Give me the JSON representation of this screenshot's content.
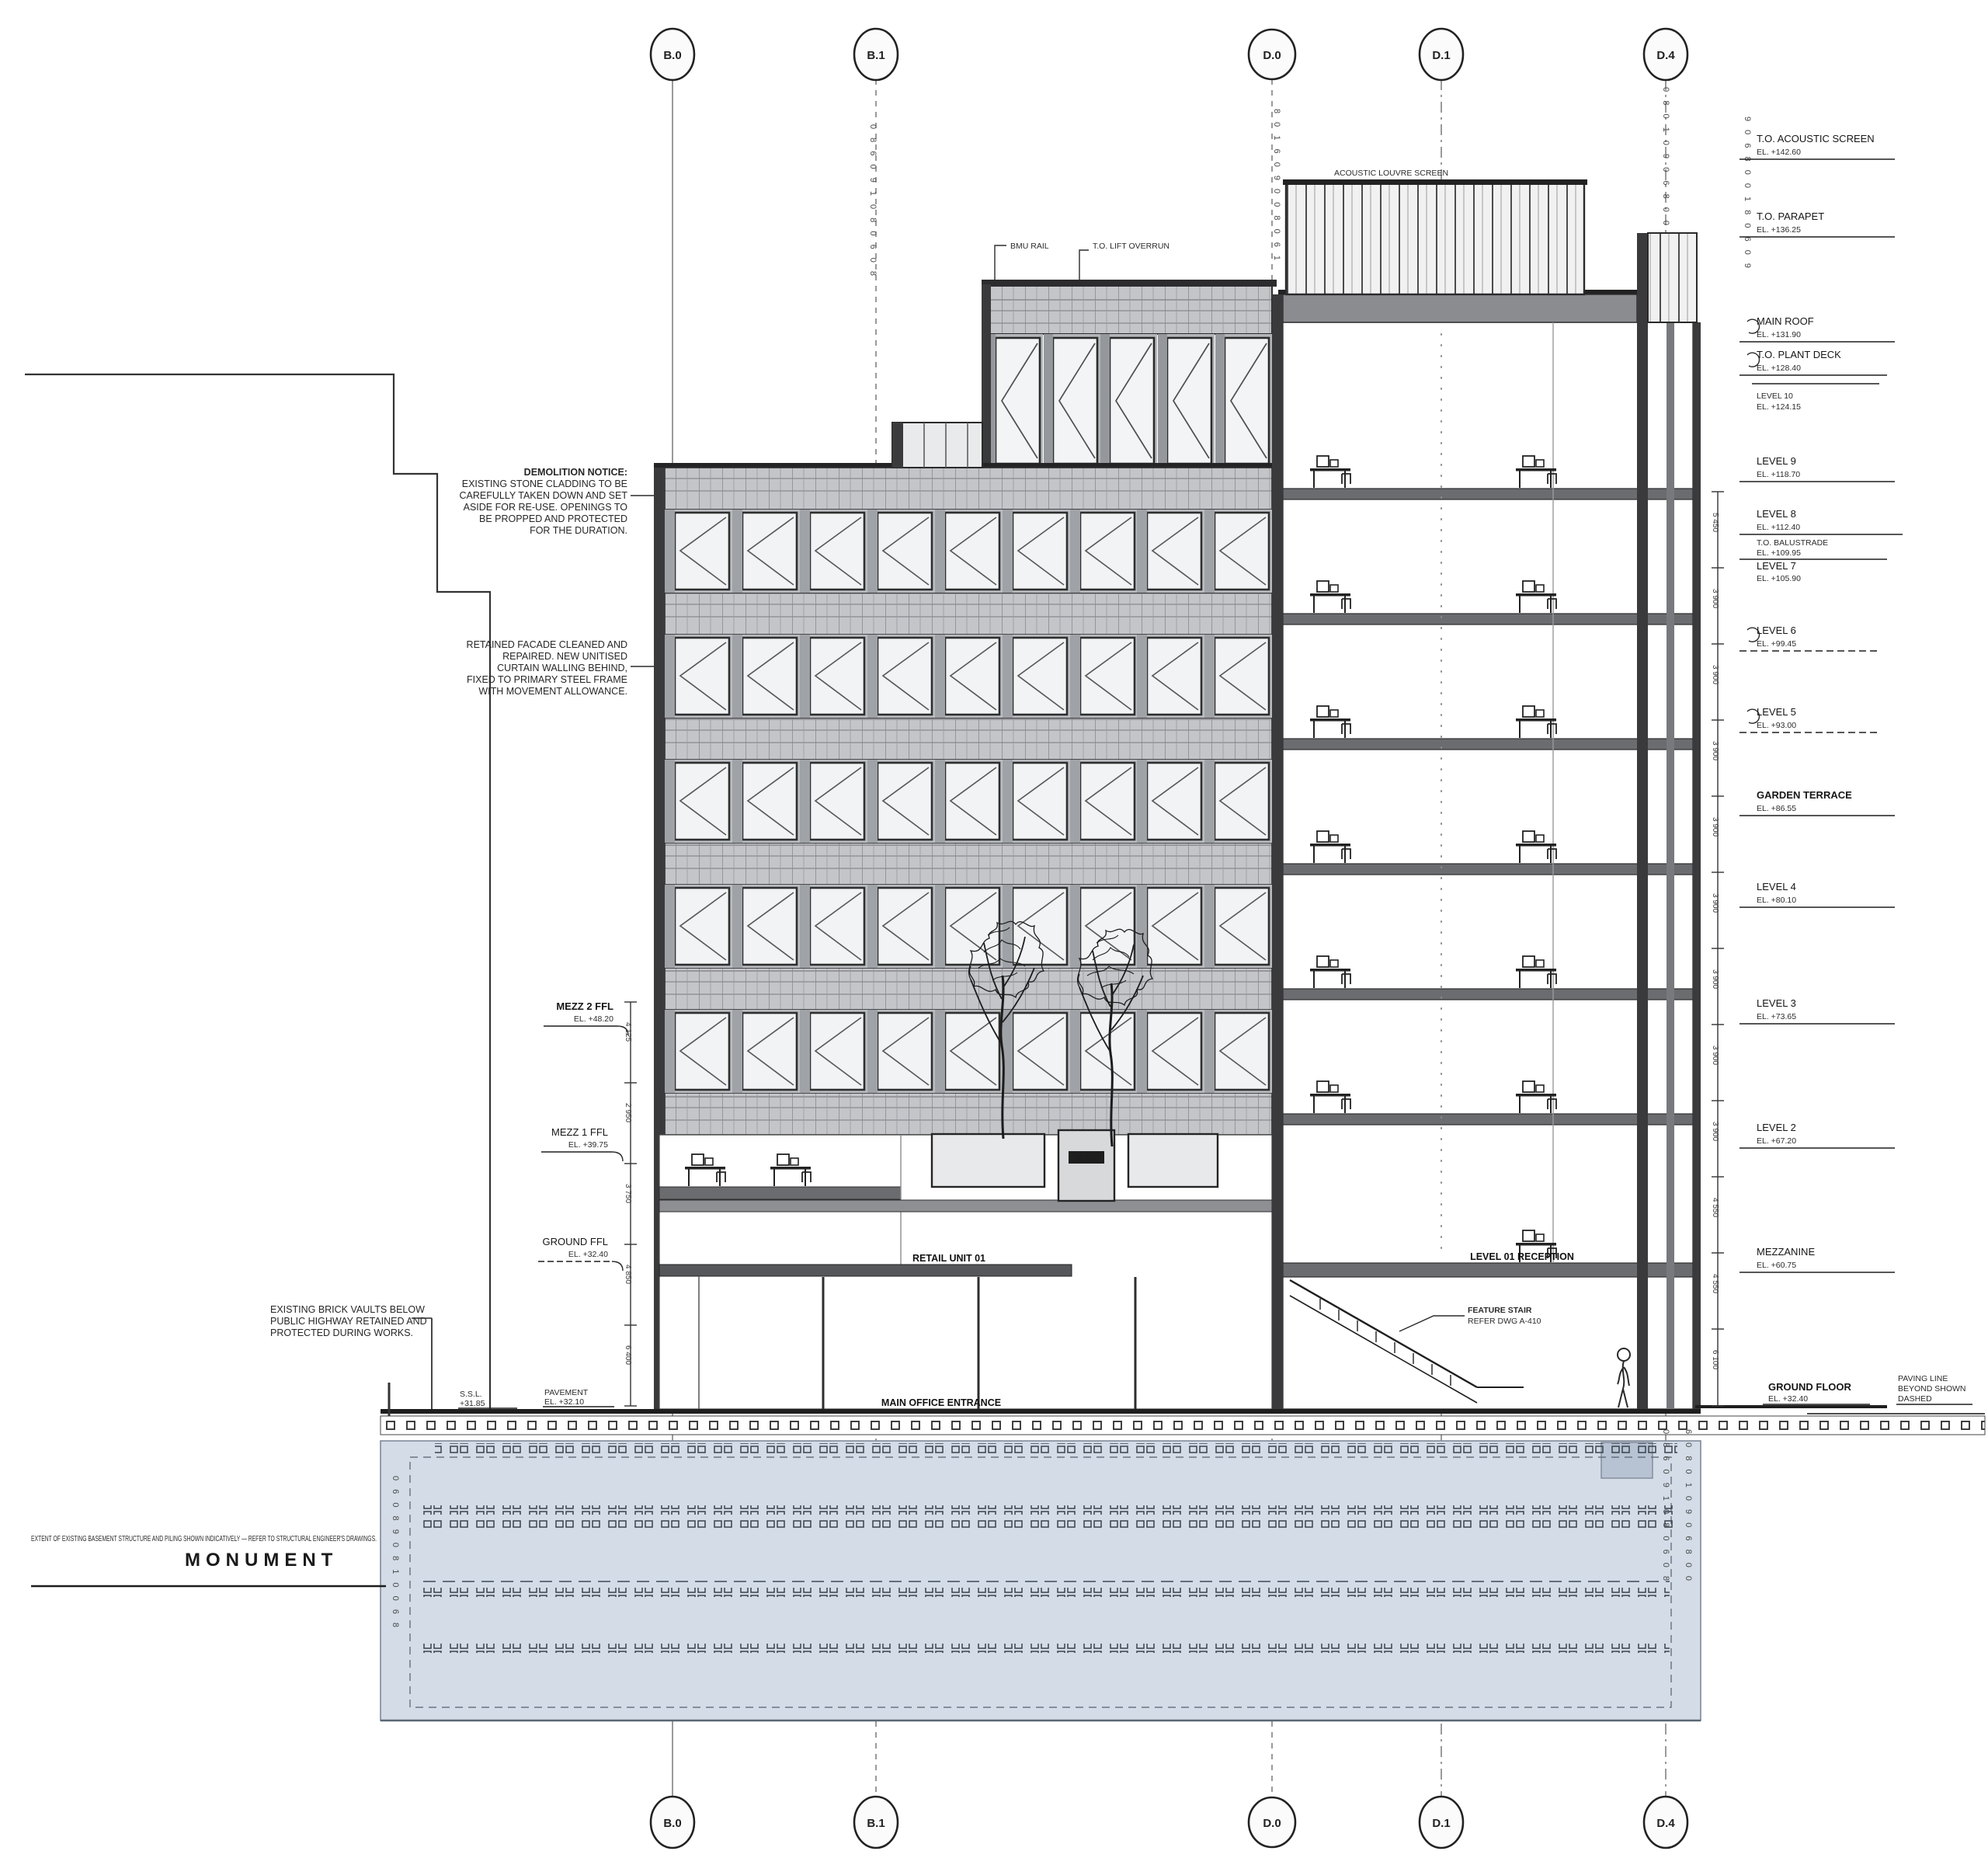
{
  "grid": {
    "top": [
      "B.0",
      "B.1",
      "D.0",
      "D.1",
      "D.4"
    ],
    "bottom": [
      "B.0",
      "B.1",
      "D.0",
      "D.1",
      "D.4"
    ]
  },
  "roof_labels": {
    "bmu": "BMU RAIL",
    "lift": "T.O. LIFT OVERRUN",
    "screen": "ACOUSTIC LOUVRE SCREEN"
  },
  "notes": {
    "a": {
      "lines": [
        "DEMOLITION NOTICE:",
        "EXISTING STONE CLADDING TO BE",
        "CAREFULLY TAKEN DOWN AND SET",
        "ASIDE FOR RE-USE. OPENINGS TO",
        "BE PROPPED AND PROTECTED",
        "FOR THE DURATION."
      ]
    },
    "b": {
      "lines": [
        "RETAINED FACADE CLEANED AND",
        "REPAIRED. NEW UNITISED",
        "CURTAIN WALLING BEHIND,",
        "FIXED TO PRIMARY STEEL FRAME",
        "WITH MOVEMENT ALLOWANCE."
      ]
    },
    "c": {
      "lines": [
        "EXISTING BRICK VAULTS BELOW",
        "PUBLIC HIGHWAY RETAINED AND",
        "PROTECTED DURING WORKS."
      ]
    },
    "boundary": "EXTENT OF EXISTING BASEMENT STRUCTURE AND PILING SHOWN INDICATIVELY — REFER TO STRUCTURAL ENGINEER'S DRAWINGS.",
    "street": "MONUMENT"
  },
  "stair": {
    "lines": [
      "FEATURE STAIR",
      "REFER DWG A-410"
    ]
  },
  "entrances": {
    "retail": "RETAIL UNIT 01",
    "main": "MAIN OFFICE ENTRANCE",
    "reception": "LEVEL 01 RECEPTION",
    "pylon": "M-001"
  },
  "left_tags": [
    {
      "l1": "MEZZ 2 FFL",
      "l2": "EL. +48.20"
    },
    {
      "l1": "MEZZ 1 FFL",
      "l2": "EL. +39.75"
    },
    {
      "l1": "GROUND FFL",
      "l2": "EL. +32.40"
    }
  ],
  "grade_left": [
    {
      "l1": "S.S.L.",
      "l2": "+31.85"
    },
    {
      "l1": "PAVEMENT",
      "l2": "EL. +32.10"
    }
  ],
  "levels_right": [
    {
      "n": "T.O. ACOUSTIC SCREEN",
      "e": "EL. +142.60"
    },
    {
      "n": "T.O. PARAPET",
      "e": "EL. +136.25"
    },
    {
      "n": "MAIN ROOF",
      "e": "EL. +131.90"
    },
    {
      "n": "T.O. PLANT DECK",
      "e": "EL. +128.40"
    },
    {
      "n": "LEVEL 10",
      "e": "EL. +124.15"
    },
    {
      "n": "LEVEL 9",
      "e": "EL. +118.70"
    },
    {
      "n": "LEVEL 8",
      "e": "EL. +112.40"
    },
    {
      "n": "T.O. BALUSTRADE",
      "e": "EL. +109.95"
    },
    {
      "n": "LEVEL 7",
      "e": "EL. +105.90"
    },
    {
      "n": "LEVEL 6",
      "e": "EL. +99.45"
    },
    {
      "n": "LEVEL 5",
      "e": "EL. +93.00"
    },
    {
      "n": "GARDEN TERRACE",
      "e": "EL. +86.55"
    },
    {
      "n": "LEVEL 4",
      "e": "EL. +80.10"
    },
    {
      "n": "LEVEL 3",
      "e": "EL. +73.65"
    },
    {
      "n": "LEVEL 2",
      "e": "EL. +67.20"
    },
    {
      "n": "MEZZANINE",
      "e": "EL. +60.75"
    }
  ],
  "ground_right": {
    "n": "GROUND FLOOR",
    "e": "EL. +32.40"
  },
  "paving": {
    "lines": [
      "PAVING LINE",
      "BEYOND SHOWN",
      "DASHED"
    ]
  },
  "dims_right": [
    "5 450",
    "3 900",
    "3 900",
    "3 900",
    "3 900",
    "3 900",
    "3 900",
    "3 900",
    "3 900",
    "4 550",
    "4 550",
    "6 100"
  ],
  "dims_left": [
    "4 125",
    "2 950",
    "3 750",
    "4 850",
    "6 400"
  ],
  "glyphs": {
    "c1": "0 8 6 0 9 1 0 8 0 6 0 8",
    "c2": "8 0 1 6 0 9 0 0 8 0 6 1",
    "c3": "6 0 8 0 1 0 9 0 6 8 0 0",
    "c4": "9 0 6 8 0 0 1 8 0 6 0 9",
    "c5": "0 6 0 8 9 0 8 1 0 0 6 8"
  }
}
